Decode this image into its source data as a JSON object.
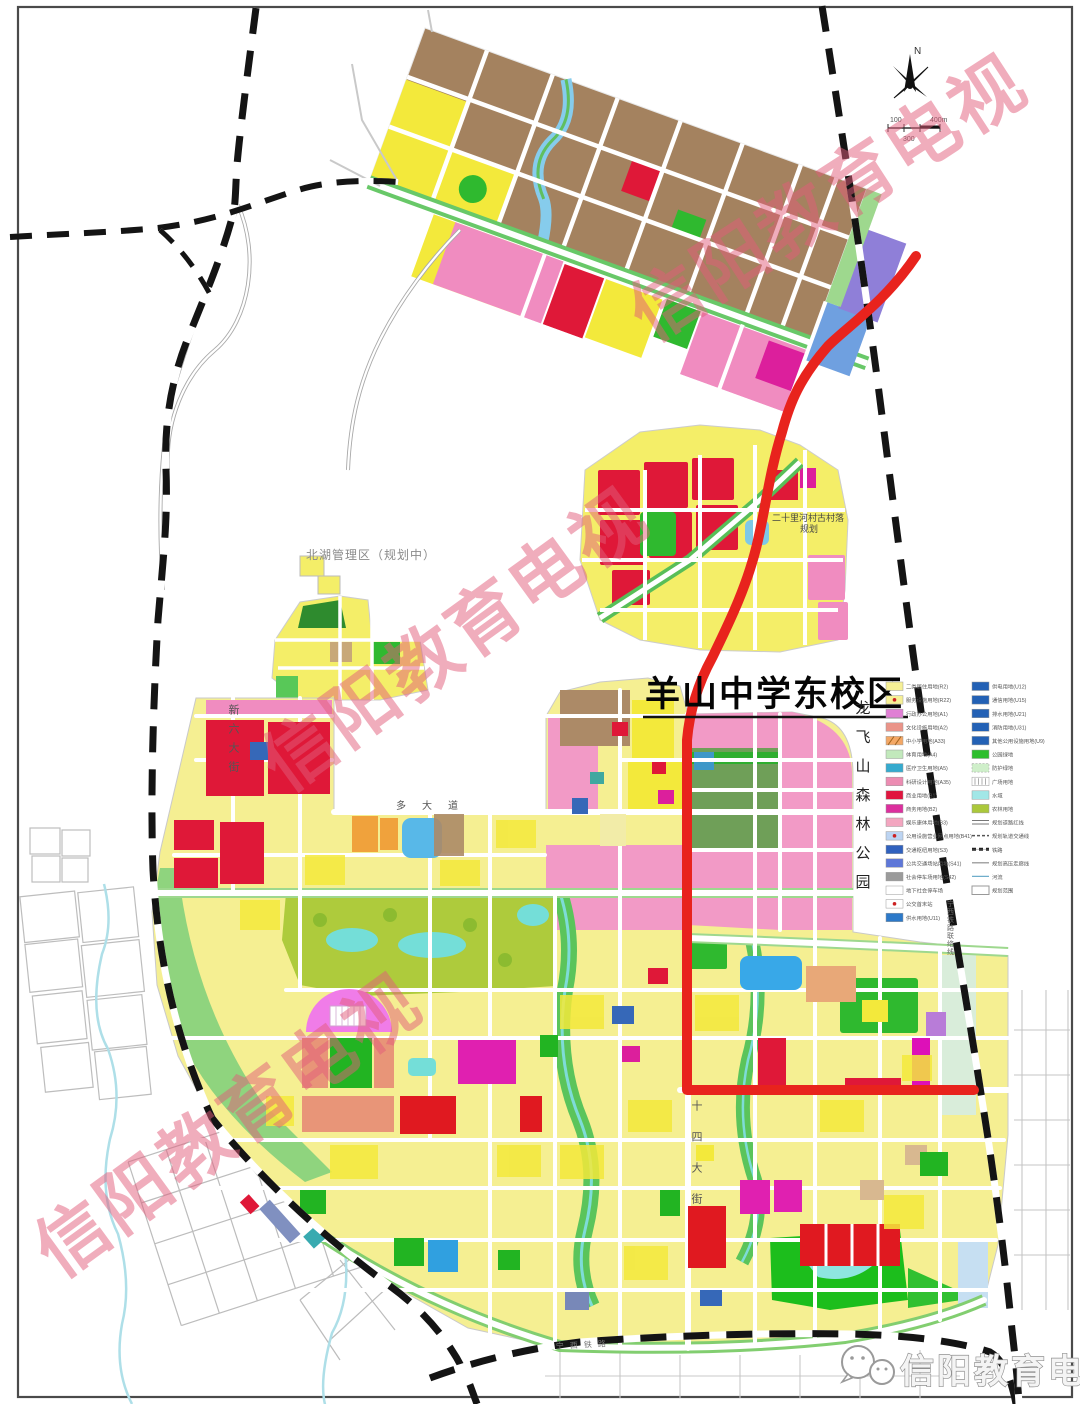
{
  "map": {
    "title_label": "羊山中学东校区",
    "area_labels": {
      "beihu": "北湖管理区（规划中）",
      "village_line1": "二十里河村古村落",
      "village_line2": "规划",
      "forest_park": "龙飞山森林公园"
    },
    "road_labels": {
      "xinliu": "新六大街",
      "shisi": "十四大街",
      "duo": "多大道",
      "rail_branch": "宁西铁路联络线",
      "rail_main": "宁西铁路"
    },
    "compass": {
      "north": "N"
    },
    "scale": {
      "left": "100",
      "mid": "300",
      "right": "400m"
    }
  },
  "legend": {
    "left": [
      {
        "label": "二类居住用地(R2)",
        "color": "#F6F096",
        "type": "rect"
      },
      {
        "label": "服务设施用地(R22)",
        "color": "#F6F096",
        "type": "rect-dot"
      },
      {
        "label": "行政办公用地(A1)",
        "color": "#E07FD4",
        "type": "rect"
      },
      {
        "label": "文化设施用地(A2)",
        "color": "#EA9489",
        "type": "rect"
      },
      {
        "label": "中小学用地(A33)",
        "color": "#F4A866",
        "type": "rect-hatch"
      },
      {
        "label": "体育用地(A4)",
        "color": "#C2E9BC",
        "type": "rect"
      },
      {
        "label": "医疗卫生用地(A5)",
        "color": "#35AACE",
        "type": "rect"
      },
      {
        "label": "科研设计用地(A35)",
        "color": "#EC8CB2",
        "type": "rect"
      },
      {
        "label": "商业用地(B1)",
        "color": "#E0163F",
        "type": "rect"
      },
      {
        "label": "商务用地(B2)",
        "color": "#DC2F9E",
        "type": "rect"
      },
      {
        "label": "娱乐康体用地(B3)",
        "color": "#F3A6C0",
        "type": "rect"
      },
      {
        "label": "公用设施营业网点用地(B41)",
        "color": "#BCD4F2",
        "type": "rect-dot"
      },
      {
        "label": "交通枢纽用地(S3)",
        "color": "#3061BE",
        "type": "rect"
      },
      {
        "label": "公共交通场站用地(S41)",
        "color": "#5E77D8",
        "type": "rect"
      },
      {
        "label": "社会停车场用地(S42)",
        "color": "#9B9B9B",
        "type": "rect"
      },
      {
        "label": "地下社会停车场",
        "color": "#FFFFFF",
        "type": "rect"
      },
      {
        "label": "公交首末站",
        "color": "#FFFFFF",
        "type": "rect-dot"
      },
      {
        "label": "供水用地(U11)",
        "color": "#2C79C9",
        "type": "rect"
      }
    ],
    "right": [
      {
        "label": "供电用地(U12)",
        "color": "#2361B5",
        "type": "rect"
      },
      {
        "label": "通信用地(U15)",
        "color": "#2361B5",
        "type": "rect"
      },
      {
        "label": "排水用地(U21)",
        "color": "#2361B5",
        "type": "rect"
      },
      {
        "label": "消防用地(U31)",
        "color": "#2361B5",
        "type": "rect"
      },
      {
        "label": "其他公用设施用地(U9)",
        "color": "#2361B5",
        "type": "rect"
      },
      {
        "label": "公园绿地",
        "color": "#2DBE2D",
        "type": "rect"
      },
      {
        "label": "防护绿地",
        "color": "#CFEFCA",
        "type": "rect-dashed"
      },
      {
        "label": "广场用地",
        "color": "#FFFFFF",
        "type": "rect-hatch-v"
      },
      {
        "label": "水域",
        "color": "#A2E7E7",
        "type": "rect"
      },
      {
        "label": "农林用地",
        "color": "#ABC83B",
        "type": "rect"
      },
      {
        "label": "规划道路红线",
        "color": "#777777",
        "type": "line-double"
      },
      {
        "label": "规划轨道交通线",
        "color": "#555555",
        "type": "line-dashed"
      },
      {
        "label": "铁路",
        "color": "#222222",
        "type": "line-rail"
      },
      {
        "label": "规划高压走廊线",
        "color": "#888888",
        "type": "line-thin"
      },
      {
        "label": "河流",
        "color": "#6FAECB",
        "type": "line-water"
      },
      {
        "label": "规划范围",
        "color": "#999999",
        "type": "box"
      }
    ]
  },
  "watermark": {
    "text": "信阳教育电视",
    "color": "rgba(226,92,122,0.50)",
    "instances": [
      {
        "x": 842,
        "y": 219,
        "rot": -33,
        "size": 72
      },
      {
        "x": 470,
        "y": 660,
        "rot": -36,
        "size": 72
      },
      {
        "x": 243,
        "y": 1146,
        "rot": -36,
        "size": 72
      }
    ]
  },
  "footer": {
    "brand": "信阳教育电视"
  },
  "colors": {
    "route_red": "#E8231D",
    "railway_black": "#141414",
    "road_white": "#FFFFFF",
    "residential_yellow": "#F5EF92",
    "bright_yellow": "#F3E93B",
    "commercial_red": "#DF1838",
    "admin_pink": "#F29AC6",
    "magenta": "#DC1F9C",
    "park_green": "#2FB92F",
    "olive_farm": "#AECB3C",
    "water_cyan": "#7CDAD8",
    "village_brown": "#A4825F",
    "purple": "#8F7FD8",
    "stadium_pink": "#F07CE8",
    "watermark_pink": "rgba(226,92,122,0.50)"
  }
}
